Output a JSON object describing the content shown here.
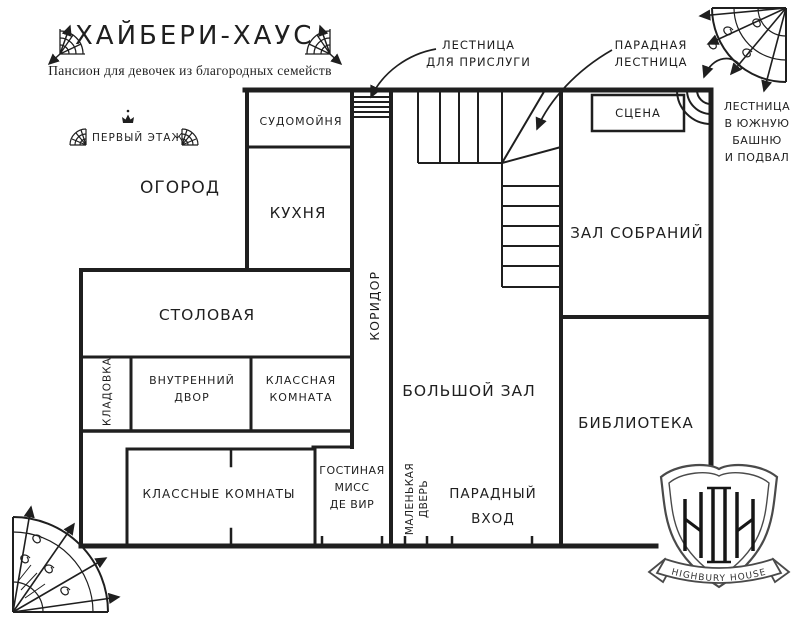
{
  "page": {
    "title": "ХАЙБЕРИ-ХАУС",
    "subtitle": "Пансион для девочек из благородных семейств",
    "floor_label": "ПЕРВЫЙ ЭТАЖ"
  },
  "rooms": {
    "garden": "ОГОРОД",
    "scullery": "СУДОМОЙНЯ",
    "kitchen": "КУХНЯ",
    "corridor": "КОРИДОР",
    "dining_room": "СТОЛОВАЯ",
    "pantry": "КЛАДОВКА",
    "courtyard": [
      "ВНУТРЕННИЙ",
      "ДВОР"
    ],
    "classroom": [
      "КЛАССНАЯ",
      "КОМНАТА"
    ],
    "classrooms": "КЛАССНЫЕ КОМНАТЫ",
    "miss_de_vere_lounge": [
      "ГОСТИНАЯ",
      "МИСС",
      "ДЕ ВИР"
    ],
    "small_door": [
      "МАЛЕНЬКАЯ",
      "ДВЕРЬ"
    ],
    "main_entrance": [
      "ПАРАДНЫЙ",
      "ВХОД"
    ],
    "great_hall": "БОЛЬШОЙ ЗАЛ",
    "assembly_hall": "ЗАЛ СОБРАНИЙ",
    "stage": "СЦЕНА",
    "library": "БИБЛИОТЕКА"
  },
  "annotations": {
    "servants_stairs": [
      "ЛЕСТНИЦА",
      "ДЛЯ ПРИСЛУГИ"
    ],
    "grand_stairs": [
      "ПАРАДНАЯ",
      "ЛЕСТНИЦА"
    ],
    "tower_stairs": [
      "ЛЕСТНИЦА",
      "В ЮЖНУЮ",
      "БАШНЮ",
      "И ПОДВАЛ"
    ]
  },
  "crest": {
    "ribbon_text": "HIGHBURY HOUSE"
  },
  "colors": {
    "ink": "#1f1f1f",
    "paper": "#ffffff",
    "crest_outline": "#4a4a4a"
  }
}
